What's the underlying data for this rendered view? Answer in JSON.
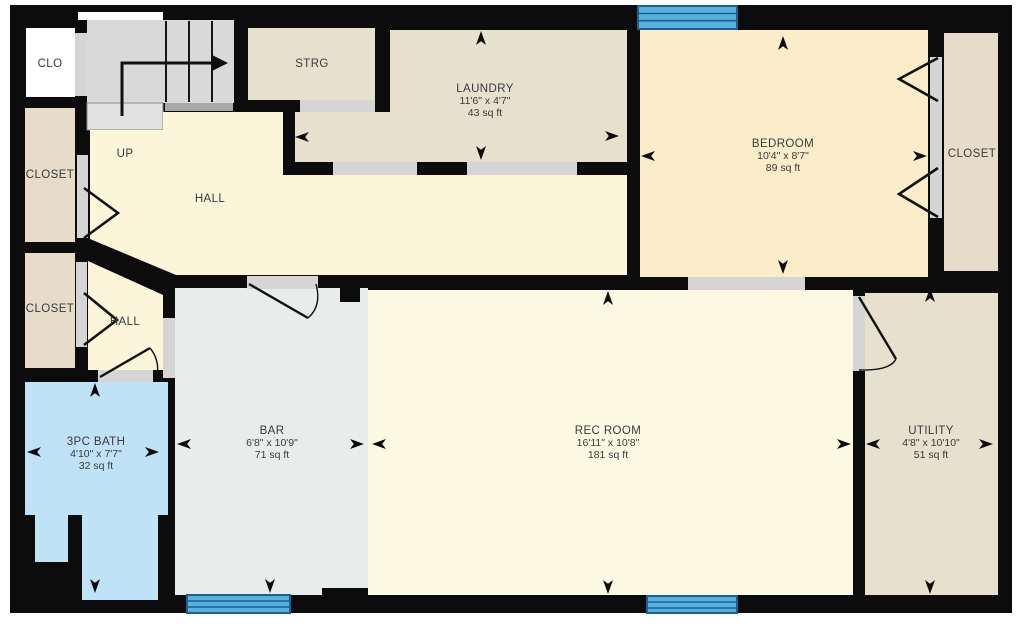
{
  "rooms": {
    "clo": {
      "label": "CLO"
    },
    "stairs": {
      "label": "UP"
    },
    "strg": {
      "label": "STRG"
    },
    "hall_upper": {
      "label": "HALL"
    },
    "hall_lower": {
      "label": "HALL"
    },
    "closet_upper": {
      "label": "CLOSET"
    },
    "closet_lower": {
      "label": "CLOSET"
    },
    "closet_bedroom": {
      "label": "CLOSET"
    },
    "laundry": {
      "name": "LAUNDRY",
      "dims": "11'6\" x 4'7\"",
      "area": "43 sq ft"
    },
    "bedroom": {
      "name": "BEDROOM",
      "dims": "10'4\" x 8'7\"",
      "area": "89 sq ft"
    },
    "bar": {
      "name": "BAR",
      "dims": "6'8\" x 10'9\"",
      "area": "71 sq ft"
    },
    "rec_room": {
      "name": "REC ROOM",
      "dims": "16'11\" x 10'8\"",
      "area": "181 sq ft"
    },
    "utility": {
      "name": "UTILITY",
      "dims": "4'8\" x 10'10\"",
      "area": "51 sq ft"
    },
    "bath": {
      "name": "3PC BATH",
      "dims": "4'10\" x 7'7\"",
      "area": "32 sq ft"
    }
  },
  "colors": {
    "wall": "#0c0c0c",
    "room_beige": "#e8e0cf",
    "room_closet": "#e6dcc9",
    "room_bedroom": "#fbedca",
    "room_hall": "#fdf5da",
    "room_rec": "#fcf9e3",
    "room_bar": "#e8edeb",
    "room_bath": "#c0e2f6",
    "stairs": "#d9d9d9",
    "opening": "#d5d5d5",
    "window_fill": "#57b1dd",
    "window_line": "#1d5f93"
  }
}
